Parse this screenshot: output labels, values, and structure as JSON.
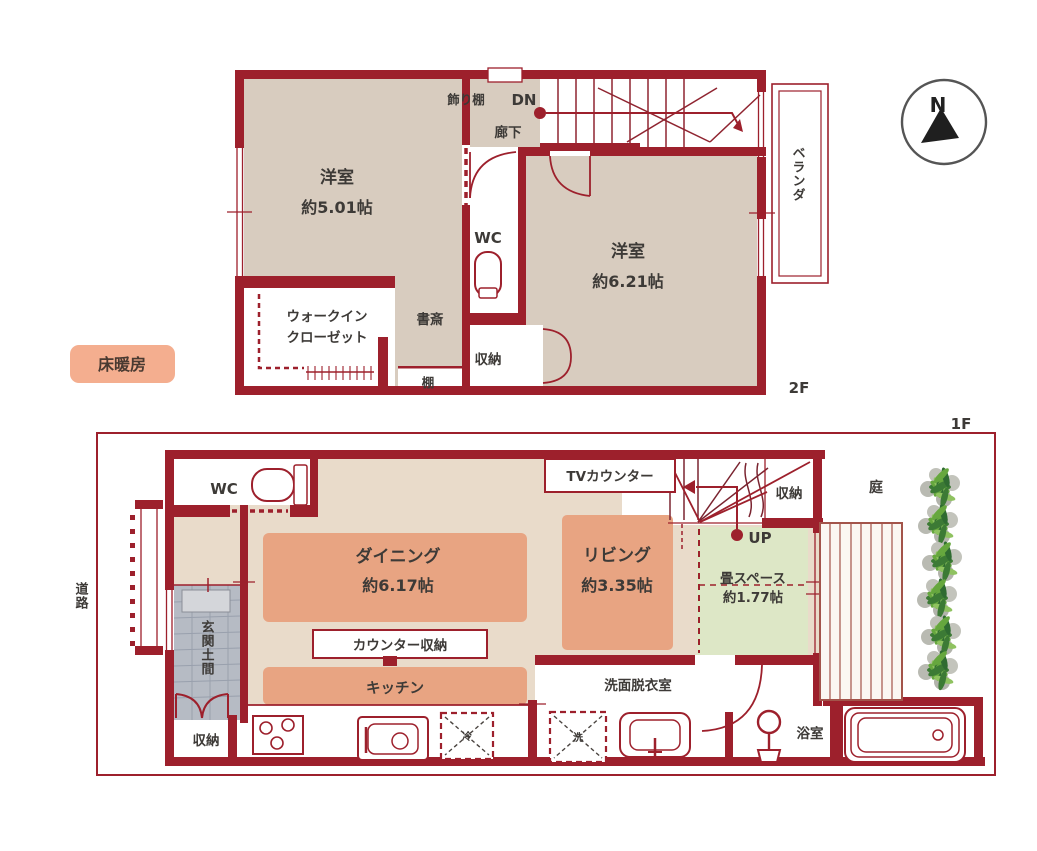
{
  "palette": {
    "wall_red": "#9d202c",
    "room_beige_2f": "#d8ccbf",
    "room_beige_1f": "#e9dbca",
    "accent_salmon": "#e8a482",
    "tatami_green": "#dde7c6",
    "entrance_gray": "#b6bbc4",
    "floor_heating_badge": "#f4ae8f"
  },
  "compass": {
    "north": "N"
  },
  "legend": {
    "floor_heating": "床暖房"
  },
  "site": {
    "road": "道路"
  },
  "floor2": {
    "floor_label": "2F",
    "display_shelf": "飾り棚",
    "down": "DN",
    "corridor": "廊下",
    "western_room_small": {
      "name": "洋室",
      "size": "約5.01帖"
    },
    "western_room_large": {
      "name": "洋室",
      "size": "約6.21帖"
    },
    "wc": "WC",
    "walk_in_closet": {
      "line1": "ウォークイン",
      "line2": "クローゼット"
    },
    "study": "書斎",
    "storage": "収納",
    "shelf": "棚",
    "veranda": "ベランダ"
  },
  "floor1": {
    "floor_label": "1F",
    "wc": "WC",
    "tv_counter": "TVカウンター",
    "storage_upper": "収納",
    "up": "UP",
    "dining": {
      "name": "ダイニング",
      "size": "約6.17帖"
    },
    "living": {
      "name": "リビング",
      "size": "約3.35帖"
    },
    "tatami_space": {
      "name": "畳スペース",
      "size": "約1.77帖"
    },
    "counter_storage": "カウンター収納",
    "kitchen": "キッチン",
    "entrance": "玄関土間",
    "storage_lower": "収納",
    "washroom": "洗面脱衣室",
    "bathroom": "浴室",
    "garden": "庭",
    "fridge_mark": "冷",
    "washer_mark": "洗"
  }
}
